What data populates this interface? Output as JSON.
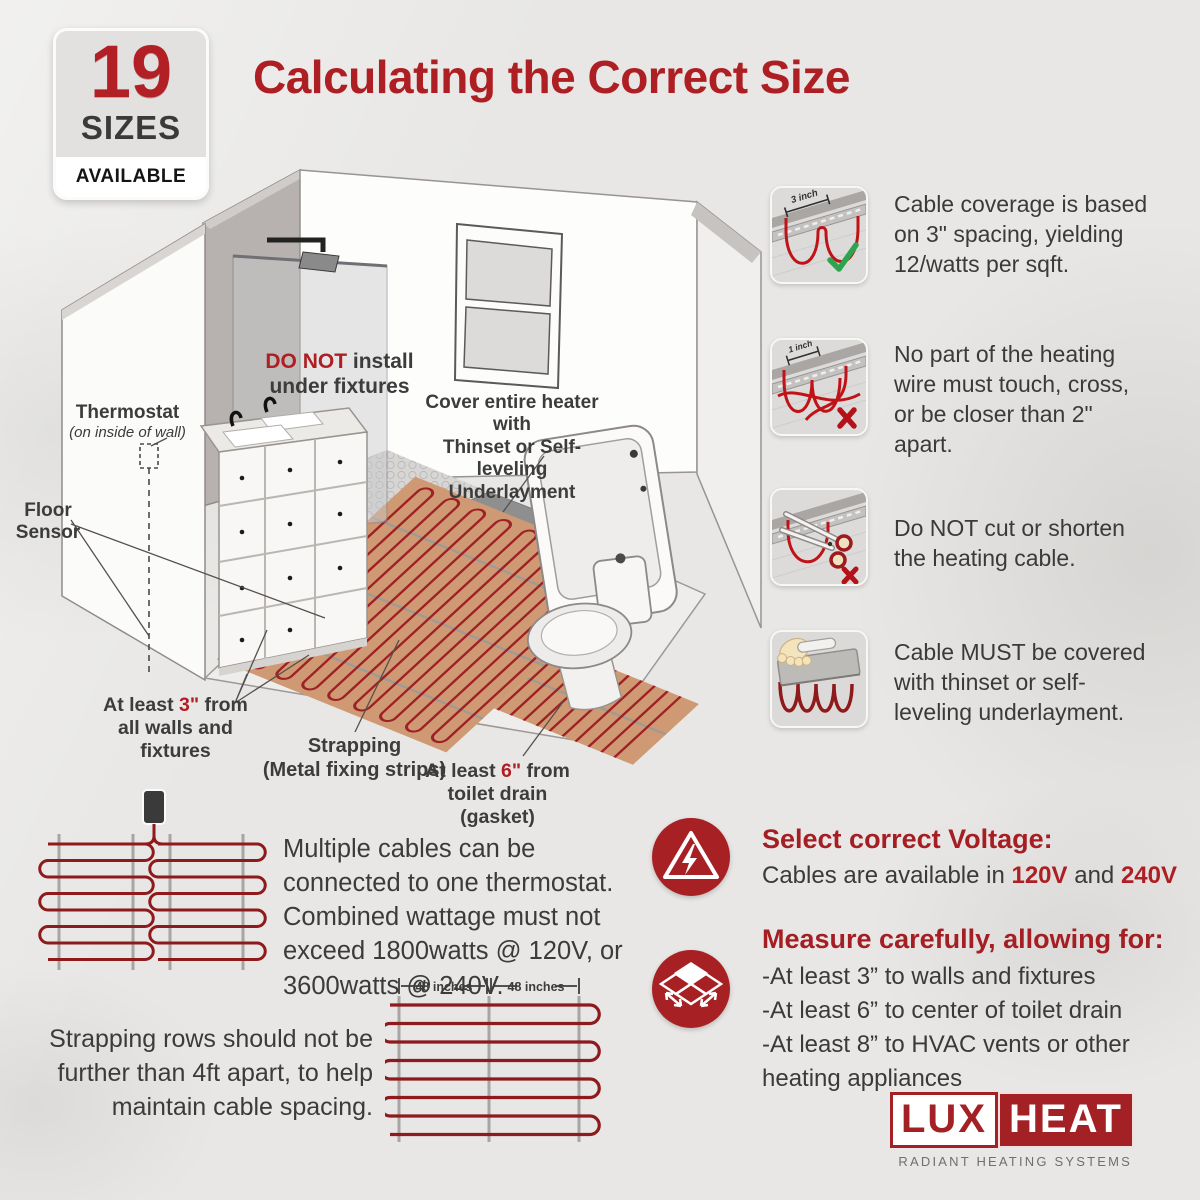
{
  "page": {
    "bg": "#e8e7e5",
    "accent": "#ae1f24",
    "cable_color": "#8e1a1c"
  },
  "badge": {
    "number": "19",
    "line1": "SIZES",
    "line2": "AVAILABLE"
  },
  "title": "Calculating the Correct Size",
  "bathroom": {
    "thermostat_label": "Thermostat",
    "thermostat_sub": "(on inside of wall)",
    "floor_sensor": "Floor\nSensor",
    "do_not_red": "DO NOT",
    "do_not_rest": " install",
    "do_not_line2": "under fixtures",
    "cover_label": "Cover entire heater with\nThinset or Self-leveling\nUnderlayment",
    "min3_pre": "At least ",
    "min3_val": "3\"",
    "min3_post": " from",
    "min3_line2": "all walls and fixtures",
    "strapping_label": "Strapping\n(Metal fixing strips)",
    "min6_pre": "At least ",
    "min6_val": "6\"",
    "min6_post": " from",
    "min6_line2": "toilet drain (gasket)"
  },
  "rules": [
    {
      "text": "Cable coverage is based on 3\" spacing, yielding 12/watts per sqft.",
      "thumb_label": "3 inch",
      "mark": "check"
    },
    {
      "text": "No part of the heating wire must touch, cross, or be closer than 2\" apart.",
      "thumb_label": "1 inch",
      "mark": "x"
    },
    {
      "text": "Do NOT cut or shorten the heating cable.",
      "mark": "x"
    },
    {
      "text": "Cable MUST be covered with thinset or self-leveling underlayment."
    }
  ],
  "multi_cable": {
    "paragraph": "Multiple cables can be connected to one thermostat. Combined wattage must not exceed 1800watts @ 120V, or 3600watts @ 240V.",
    "strapping_note": "Strapping rows should not be further than 4ft apart, to help maintain cable spacing.",
    "dim_label_left": "48 inches",
    "dim_label_right": "48 inches"
  },
  "voltage": {
    "title": "Select correct Voltage:",
    "pre": "Cables are available in ",
    "v1": "120V",
    "and": " and ",
    "v2": "240V"
  },
  "measure": {
    "title": "Measure carefully, allowing for:",
    "items": [
      "-At least 3” to walls and fixtures",
      "-At least 6” to center of toilet drain",
      "-At least 8” to HVAC vents or other heating appliances"
    ]
  },
  "logo": {
    "lux": "LUX",
    "heat": "HEAT",
    "tagline": "RADIANT HEATING SYSTEMS"
  }
}
